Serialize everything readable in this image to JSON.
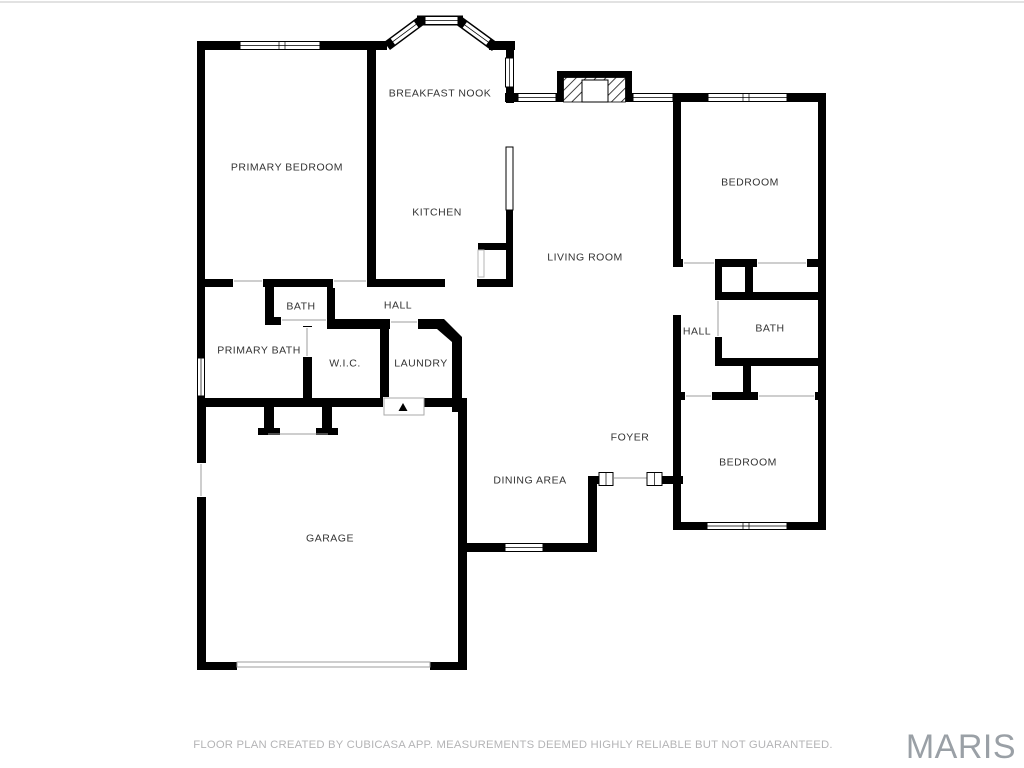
{
  "rooms": {
    "primary_bedroom": {
      "label": "PRIMARY BEDROOM"
    },
    "breakfast_nook": {
      "label": "BREAKFAST NOOK"
    },
    "kitchen": {
      "label": "KITCHEN"
    },
    "living_room": {
      "label": "LIVING ROOM"
    },
    "bedroom_top_right": {
      "label": "BEDROOM"
    },
    "bath_left": {
      "label": "BATH"
    },
    "hall_left": {
      "label": "HALL"
    },
    "primary_bath": {
      "label": "PRIMARY BATH"
    },
    "wic": {
      "label": "W.I.C."
    },
    "laundry": {
      "label": "LAUNDRY"
    },
    "hall_right": {
      "label": "HALL"
    },
    "bath_right": {
      "label": "BATH"
    },
    "foyer": {
      "label": "FOYER"
    },
    "dining_area": {
      "label": "DINING AREA"
    },
    "bedroom_bottom_right": {
      "label": "BEDROOM"
    },
    "garage": {
      "label": "GARAGE"
    }
  },
  "footer": {
    "disclaimer": "FLOOR PLAN CREATED BY CUBICASA APP. MEASUREMENTS DEEMED HIGHLY RELIABLE BUT NOT GUARANTEED."
  },
  "watermark": {
    "brand": "MARIS"
  },
  "colors": {
    "wall": "#000000",
    "room_label": "#333333",
    "disclaimer_text": "#b4b4b6",
    "watermark_text": "#9aa0a6",
    "door_symbol": "#9c9c9c",
    "background": "#ffffff"
  }
}
